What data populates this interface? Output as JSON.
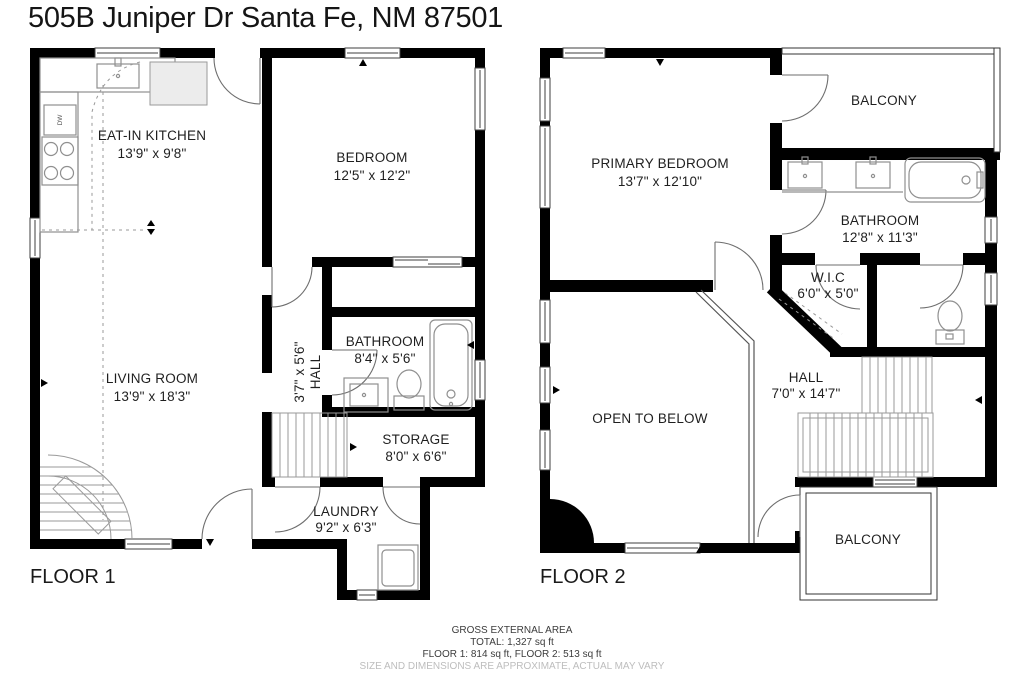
{
  "title": "505B Juniper Dr Santa Fe, NM 87501",
  "colors": {
    "wall": "#000000",
    "fixture": "#8f8f8f",
    "text": "#1f1f1f",
    "disclaimer": "#bdbdbd"
  },
  "floor1": {
    "label": "FLOOR 1",
    "rooms": {
      "kitchen": {
        "name": "EAT-IN KITCHEN",
        "dims": "13'9\" x 9'8\""
      },
      "bedroom": {
        "name": "BEDROOM",
        "dims": "12'5\" x 12'2\""
      },
      "living": {
        "name": "LIVING ROOM",
        "dims": "13'9\" x 18'3\""
      },
      "hall": {
        "name": "HALL",
        "dims": "3'7\" x 5'6\""
      },
      "bathroom": {
        "name": "BATHROOM",
        "dims": "8'4\" x 5'6\""
      },
      "storage": {
        "name": "STORAGE",
        "dims": "8'0\" x 6'6\""
      },
      "laundry": {
        "name": "LAUNDRY",
        "dims": "9'2\" x 6'3\""
      }
    },
    "fixtures": {
      "dishwasher": "DW"
    }
  },
  "floor2": {
    "label": "FLOOR 2",
    "rooms": {
      "primary": {
        "name": "PRIMARY BEDROOM",
        "dims": "13'7\" x 12'10\""
      },
      "balcony_upper": {
        "name": "BALCONY"
      },
      "bathroom": {
        "name": "BATHROOM",
        "dims": "12'8\" x 11'3\""
      },
      "wic": {
        "name": "W.I.C",
        "dims": "6'0\" x 5'0\""
      },
      "hall": {
        "name": "HALL",
        "dims": "7'0\" x 14'7\""
      },
      "open_below": {
        "name": "OPEN TO BELOW"
      },
      "balcony_lower": {
        "name": "BALCONY"
      }
    }
  },
  "footer": {
    "area_heading": "GROSS EXTERNAL AREA",
    "total": "TOTAL: 1,327 sq ft",
    "floors": "FLOOR 1: 814 sq ft, FLOOR 2: 513 sq ft",
    "disclaimer": "SIZE AND DIMENSIONS ARE APPROXIMATE, ACTUAL MAY VARY"
  }
}
